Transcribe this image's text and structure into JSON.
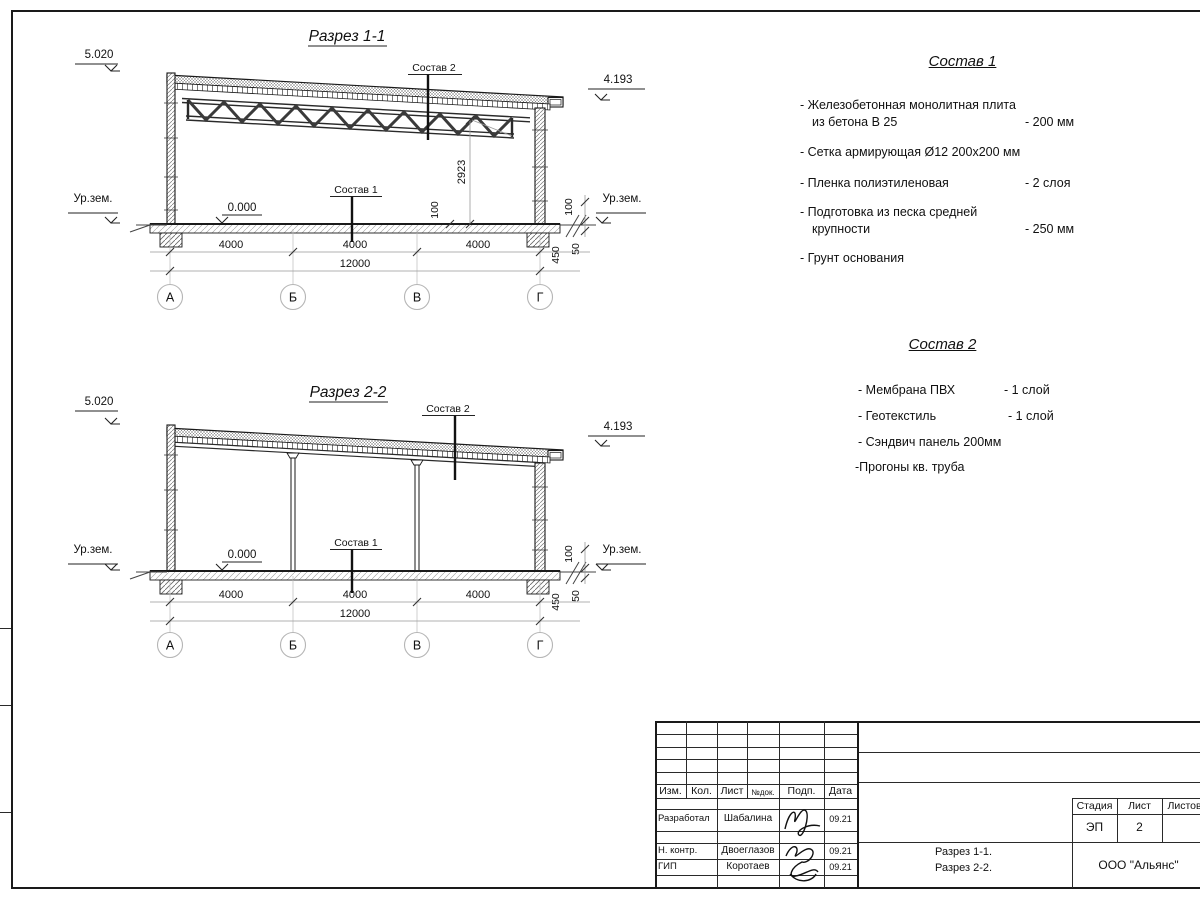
{
  "section1": {
    "title": "Разрез 1-1",
    "elev_top": "5.020",
    "elev_right": "4.193",
    "zero": "0.000",
    "ground_left": "Ур.зем.",
    "ground_right": "Ур.зем.",
    "comp1_label": "Состав 1",
    "comp2_label": "Состав 2",
    "dim_height": "2923",
    "dim_100_left": "100",
    "dim_100_right": "100",
    "dim_450": "450",
    "dim_50": "50",
    "spans": [
      "4000",
      "4000",
      "4000"
    ],
    "total": "12000",
    "axes": [
      "А",
      "Б",
      "В",
      "Г"
    ]
  },
  "section2": {
    "title": "Разрез 2-2",
    "elev_top": "5.020",
    "elev_right": "4.193",
    "zero": "0.000",
    "ground_left": "Ур.зем.",
    "ground_right": "Ур.зем.",
    "comp1_label": "Состав 1",
    "comp2_label": "Состав 2",
    "dim_100_right": "100",
    "dim_450": "450",
    "dim_50": "50",
    "spans": [
      "4000",
      "4000",
      "4000"
    ],
    "total": "12000",
    "axes": [
      "А",
      "Б",
      "В",
      "Г"
    ]
  },
  "sostav1": {
    "title": "Состав 1",
    "rows": [
      {
        "text": "- Железобетонная  монолитная плита",
        "value": ""
      },
      {
        "text": "из бетона В 25",
        "value": "- 200 мм"
      },
      {
        "text": "- Сетка армирующая Ø12 200x200 мм",
        "value": ""
      },
      {
        "text": "- Пленка полиэтиленовая",
        "value": "-  2 слоя"
      },
      {
        "text": "- Подготовка из песка средней",
        "value": ""
      },
      {
        "text": "крупности",
        "value": "- 250 мм"
      },
      {
        "text": "- Грунт основания",
        "value": ""
      }
    ]
  },
  "sostav2": {
    "title": "Состав 2",
    "rows": [
      {
        "text": "- Мембрана ПВХ",
        "value": "- 1 слой"
      },
      {
        "text": "- Геотекстиль",
        "value": "- 1 слой"
      },
      {
        "text": "- Сэндвич панель 200мм",
        "value": ""
      },
      {
        "text": "-Прогоны кв. труба",
        "value": ""
      }
    ]
  },
  "titleblock": {
    "col_headers": [
      "Изм.",
      "Кол.",
      "Лист",
      "№док.",
      "Подп.",
      "Дата"
    ],
    "rows": [
      {
        "role": "Разработал",
        "name": "Шабалина",
        "date": "09.21"
      },
      {
        "role": "Н. контр.",
        "name": "Двоеглазов",
        "date": "09.21"
      },
      {
        "role": "ГИП",
        "name": "Коротаев",
        "date": "09.21"
      }
    ],
    "stage_label": "Стадия",
    "sheet_label": "Лист",
    "sheets_label": "Листов",
    "stage_value": "ЭП",
    "sheet_value": "2",
    "doc_line1": "Разрез 1-1.",
    "doc_line2": "Разрез 2-2.",
    "company": "ООО \"Альянс\""
  }
}
